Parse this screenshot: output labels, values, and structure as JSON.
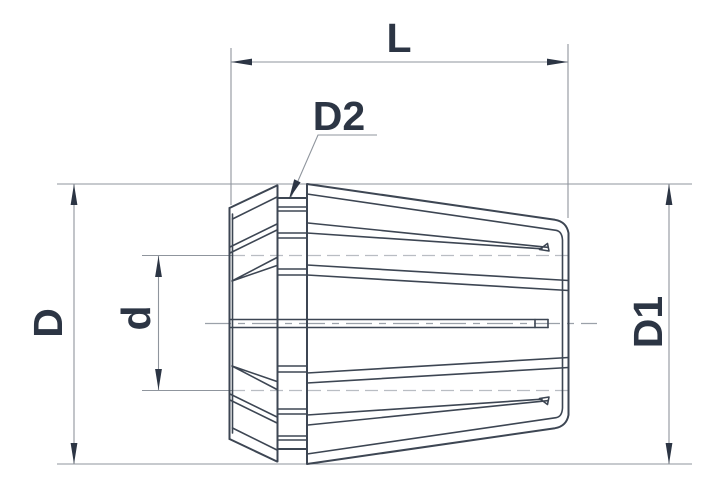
{
  "drawing": {
    "labels": {
      "overall_length": "L",
      "groove_diameter": "D2",
      "body_diameter": "D",
      "bore_diameter": "d",
      "front_diameter": "D1"
    },
    "colors": {
      "background": "#ffffff",
      "part_line": "#3d4653",
      "dimension_line": "#8f959d",
      "hidden_line": "#b9bdc3",
      "centerline": "#9ba1a9",
      "label_text": "#2c3544",
      "arrowhead": "#2c3544"
    }
  }
}
